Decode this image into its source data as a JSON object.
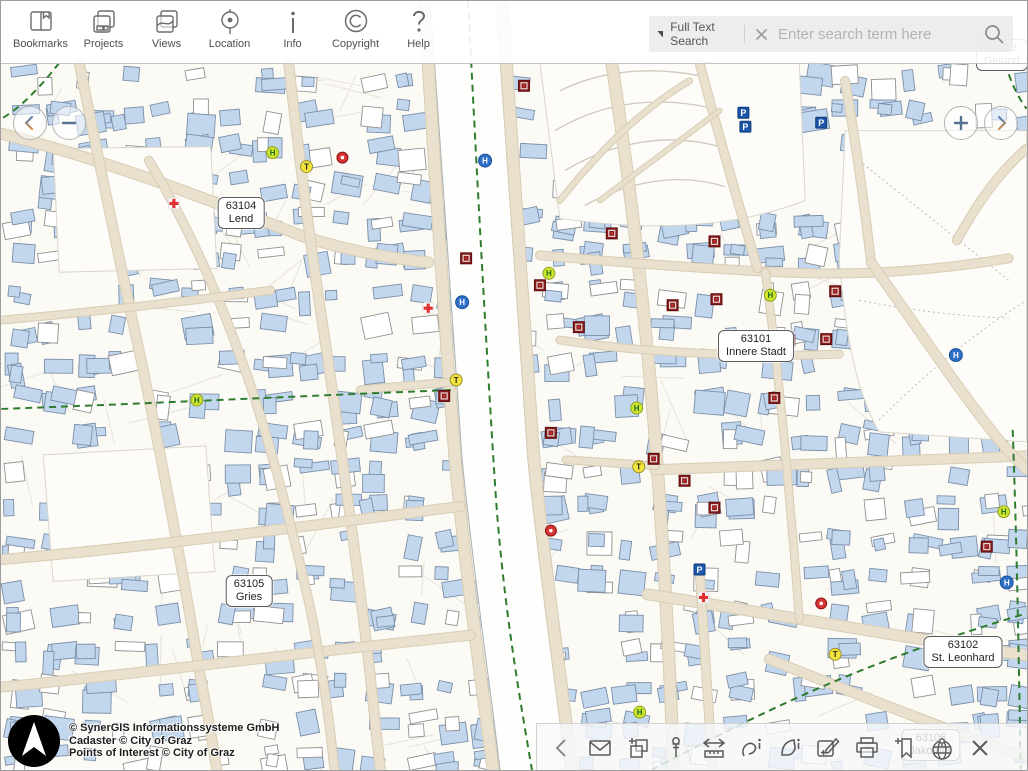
{
  "top_toolbar": {
    "items": [
      {
        "id": "bookmarks",
        "label": "Bookmarks",
        "icon": "book-icon"
      },
      {
        "id": "projects",
        "label": "Projects",
        "icon": "stacked-pages-icon"
      },
      {
        "id": "views",
        "label": "Views",
        "icon": "map-pages-icon"
      },
      {
        "id": "location",
        "label": "Location",
        "icon": "target-icon"
      },
      {
        "id": "info",
        "label": "Info",
        "icon": "info-icon"
      },
      {
        "id": "copyright",
        "label": "Copyright",
        "icon": "copyright-icon"
      },
      {
        "id": "help",
        "label": "Help",
        "icon": "question-icon"
      }
    ]
  },
  "search": {
    "filter_label": "Full Text Search",
    "filter_icon": "triangle-down-icon",
    "clear_icon": "close-icon",
    "placeholder": "Enter search term here",
    "submit_icon": "search-icon"
  },
  "nav_controls": {
    "pan_left_icon": "chevron-left-icon",
    "zoom_out_icon": "minus-icon",
    "zoom_in_icon": "plus-icon",
    "pan_right_icon": "chevron-right-icon"
  },
  "attribution": {
    "logo_icon": "north-arrow-logo",
    "lines": [
      "© SynerGIS Informationssysteme GmbH",
      "Cadaster © City of Graz",
      "Points of Interest © City of Graz"
    ]
  },
  "bottom_toolbar": {
    "tools": [
      {
        "id": "collapse",
        "icon": "chevron-left-icon"
      },
      {
        "id": "mail",
        "icon": "envelope-icon"
      },
      {
        "id": "copy-add",
        "icon": "layers-plus-icon"
      },
      {
        "id": "pin",
        "icon": "pushpin-icon"
      },
      {
        "id": "measure",
        "icon": "measure-ruler-icon"
      },
      {
        "id": "identify-line",
        "icon": "line-info-icon"
      },
      {
        "id": "identify-area",
        "icon": "polygon-info-icon"
      },
      {
        "id": "draw-edit",
        "icon": "edit-pencil-plus-icon"
      },
      {
        "id": "print",
        "icon": "printer-icon"
      },
      {
        "id": "add-bookmark",
        "icon": "bookmark-plus-icon"
      },
      {
        "id": "overview",
        "icon": "globe-pin-icon"
      },
      {
        "id": "close",
        "icon": "close-icon"
      }
    ]
  },
  "map": {
    "districts": [
      {
        "code": "63104",
        "name": "Lend",
        "x": 240,
        "y": 212
      },
      {
        "code": "63101",
        "name": "Innere Stadt",
        "x": 755,
        "y": 345
      },
      {
        "code": "63105",
        "name": "Gries",
        "x": 248,
        "y": 590
      },
      {
        "code": "63102",
        "name": "St. Leonhard",
        "x": 962,
        "y": 651
      },
      {
        "code": "63103",
        "name": "Geidorf",
        "x": 1001,
        "y": 54
      },
      {
        "code": "63106",
        "name": "Jakomini",
        "x": 930,
        "y": 744
      }
    ],
    "pois": [
      {
        "type": "red-diamond",
        "x": 524,
        "y": 85
      },
      {
        "type": "red-diamond",
        "x": 466,
        "y": 258
      },
      {
        "type": "red-diamond",
        "x": 540,
        "y": 285
      },
      {
        "type": "red-diamond",
        "x": 612,
        "y": 233
      },
      {
        "type": "red-diamond",
        "x": 715,
        "y": 241
      },
      {
        "type": "red-diamond",
        "x": 673,
        "y": 305
      },
      {
        "type": "red-diamond",
        "x": 717,
        "y": 299
      },
      {
        "type": "red-diamond",
        "x": 579,
        "y": 327
      },
      {
        "type": "red-diamond",
        "x": 836,
        "y": 291
      },
      {
        "type": "red-diamond",
        "x": 827,
        "y": 339
      },
      {
        "type": "red-diamond",
        "x": 790,
        "y": 340
      },
      {
        "type": "red-diamond",
        "x": 444,
        "y": 396
      },
      {
        "type": "red-diamond",
        "x": 551,
        "y": 433
      },
      {
        "type": "red-diamond",
        "x": 654,
        "y": 459
      },
      {
        "type": "red-diamond",
        "x": 685,
        "y": 481
      },
      {
        "type": "red-diamond",
        "x": 715,
        "y": 508
      },
      {
        "type": "red-diamond",
        "x": 775,
        "y": 398
      },
      {
        "type": "red-diamond",
        "x": 988,
        "y": 547
      },
      {
        "type": "bus-stop-h",
        "x": 272,
        "y": 152
      },
      {
        "type": "bus-stop-h",
        "x": 549,
        "y": 273
      },
      {
        "type": "bus-stop-h",
        "x": 771,
        "y": 295
      },
      {
        "type": "bus-stop-h",
        "x": 196,
        "y": 400
      },
      {
        "type": "bus-stop-h",
        "x": 640,
        "y": 713
      },
      {
        "type": "bus-stop-h",
        "x": 1005,
        "y": 512
      },
      {
        "type": "bus-stop-h",
        "x": 637,
        "y": 408
      },
      {
        "type": "blue-h",
        "x": 485,
        "y": 160
      },
      {
        "type": "blue-h",
        "x": 462,
        "y": 302
      },
      {
        "type": "blue-h",
        "x": 957,
        "y": 355
      },
      {
        "type": "blue-h",
        "x": 1008,
        "y": 583
      },
      {
        "type": "taxi-t",
        "x": 306,
        "y": 166
      },
      {
        "type": "taxi-t",
        "x": 456,
        "y": 380
      },
      {
        "type": "taxi-t",
        "x": 639,
        "y": 467
      },
      {
        "type": "taxi-t",
        "x": 836,
        "y": 655
      },
      {
        "type": "parking-p",
        "x": 744,
        "y": 112
      },
      {
        "type": "parking-p",
        "x": 746,
        "y": 126
      },
      {
        "type": "parking-p",
        "x": 822,
        "y": 122
      },
      {
        "type": "parking-p",
        "x": 700,
        "y": 570
      },
      {
        "type": "red-cross",
        "x": 173,
        "y": 203
      },
      {
        "type": "red-cross",
        "x": 428,
        "y": 308
      },
      {
        "type": "red-cross",
        "x": 704,
        "y": 598
      },
      {
        "type": "red-circle",
        "x": 342,
        "y": 157
      },
      {
        "type": "red-circle",
        "x": 551,
        "y": 531
      },
      {
        "type": "red-circle",
        "x": 822,
        "y": 604
      }
    ],
    "colors": {
      "background": "#fbfaf5",
      "parcel": "#e6e3da",
      "building_fill": "#c2d6ee",
      "building_stroke": "#7a8fa8",
      "building_alt_fill": "#ffffff",
      "building_alt_stroke": "#909090",
      "park_fill": "#fdfcf8",
      "contour": "#cfc9bb",
      "park_path": "#bbbbbb",
      "river_fill": "#fefefc",
      "bank_stroke": "#a8b0b4",
      "street_fill": "#e9e0cd",
      "street_casing": "#d8cdb6",
      "boundary_green": "#2e7d2e",
      "poi_diamond": "#8a1c1c",
      "poi_bus": "#cfe32f",
      "poi_blue": "#2e6fc7",
      "poi_taxi": "#f3e33b",
      "poi_parking": "#1c55aa",
      "poi_red": "#d63333"
    },
    "geometry": {
      "river": "M430,0 L496,0 C508,160 518,320 528,460 C540,580 558,700 566,771 L500,771 C492,700 474,580 462,460 C452,320 442,160 430,0 Z",
      "banks": [
        "M430,0 C442,160 452,320 462,460 C474,580 492,700 500,771",
        "M496,0 C508,160 518,320 528,460 C540,580 558,700 566,771"
      ],
      "quays": [
        {
          "d": "M424,0 C434,160 444,320 455,460 C466,580 484,700 493,771",
          "w": 11
        },
        {
          "d": "M502,0 C514,160 524,320 534,460 C546,580 564,700 572,771",
          "w": 11
        }
      ],
      "streets": [
        {
          "d": "M0,133 C100,158 200,196 300,235 C345,250 390,258 428,262",
          "w": 10
        },
        {
          "d": "M78,62 C100,170 118,260 138,350 C158,445 180,560 200,680 C206,710 212,745 216,771",
          "w": 9
        },
        {
          "d": "M288,62 C300,170 312,260 326,350 C340,445 356,560 368,660 C372,700 377,740 380,771",
          "w": 9
        },
        {
          "d": "M0,560 C140,548 280,530 420,512 C434,510 448,508 460,507",
          "w": 9
        },
        {
          "d": "M0,688 C160,672 330,650 470,636",
          "w": 9
        },
        {
          "d": "M148,160 C190,230 220,300 248,380 C270,445 292,530 310,610 C318,650 328,710 334,771",
          "w": 8
        },
        {
          "d": "M0,320 C90,312 180,302 270,290",
          "w": 7
        },
        {
          "d": "M360,390 C400,386 430,384 452,382",
          "w": 7
        },
        {
          "d": "M612,62 C630,180 644,300 654,420 C662,520 668,620 672,720 L674,771",
          "w": 11
        },
        {
          "d": "M540,255 C620,262 700,268 780,272 C860,276 940,270 1010,258",
          "w": 8
        },
        {
          "d": "M655,470 C760,466 870,462 980,458 L1028,456",
          "w": 9
        },
        {
          "d": "M648,595 C760,612 880,634 1000,652 L1028,656",
          "w": 10
        },
        {
          "d": "M700,62 C718,130 738,200 758,268",
          "w": 8
        },
        {
          "d": "M846,80 C858,150 866,210 872,262",
          "w": 8
        },
        {
          "d": "M872,262 C920,330 960,390 1000,440 C1010,452 1020,462 1028,470",
          "w": 9
        },
        {
          "d": "M958,240 C980,200 1002,170 1028,148",
          "w": 8
        },
        {
          "d": "M700,570 C704,628 708,690 712,755 L713,771",
          "w": 8
        },
        {
          "d": "M770,660 C850,692 930,724 1010,752 L1028,758",
          "w": 9
        },
        {
          "d": "M566,460 C600,462 630,464 656,466",
          "w": 7
        },
        {
          "d": "M560,340 C600,346 640,350 680,352 C730,355 790,356 840,354",
          "w": 7
        },
        {
          "d": "M766,272 C774,330 780,390 786,450 C790,500 796,560 800,620",
          "w": 7
        },
        {
          "d": "M560,200 C600,150 640,110 690,80",
          "w": 5
        },
        {
          "d": "M600,200 C640,170 680,140 720,110",
          "w": 4
        }
      ],
      "parks": [
        "M540,62 L800,62 L806,200 C740,226 660,232 560,218 Z",
        "M846,130 L1028,130 L1028,442 L880,432 C856,390 846,330 840,260 Z",
        "M52,148 L210,146 L216,268 L58,272 Z",
        "M42,455 L205,446 L214,572 L52,582 Z"
      ],
      "contours": [
        "M560,90 C600,70 650,65 700,75",
        "M555,130 C605,100 660,95 715,108",
        "M565,170 C615,140 670,132 720,146",
        "M585,205 C630,180 680,172 725,186"
      ],
      "park_paths": [
        "M860,160 C910,200 960,240 1010,280",
        "M880,420 C930,370 980,330 1028,300",
        "M860,300 C910,310 960,316 1010,318"
      ],
      "boundaries": [
        "M468,0 C478,200 488,380 496,500 C504,610 520,700 532,771",
        "M0,409 C140,404 300,396 452,390",
        "M58,62 C38,88 18,108 0,118",
        "M652,771 C720,735 790,700 860,672 C920,648 980,628 1028,614",
        "M1014,430 C1018,540 1020,650 1022,771",
        "M1006,62 C1012,80 1018,95 1028,108"
      ]
    }
  }
}
